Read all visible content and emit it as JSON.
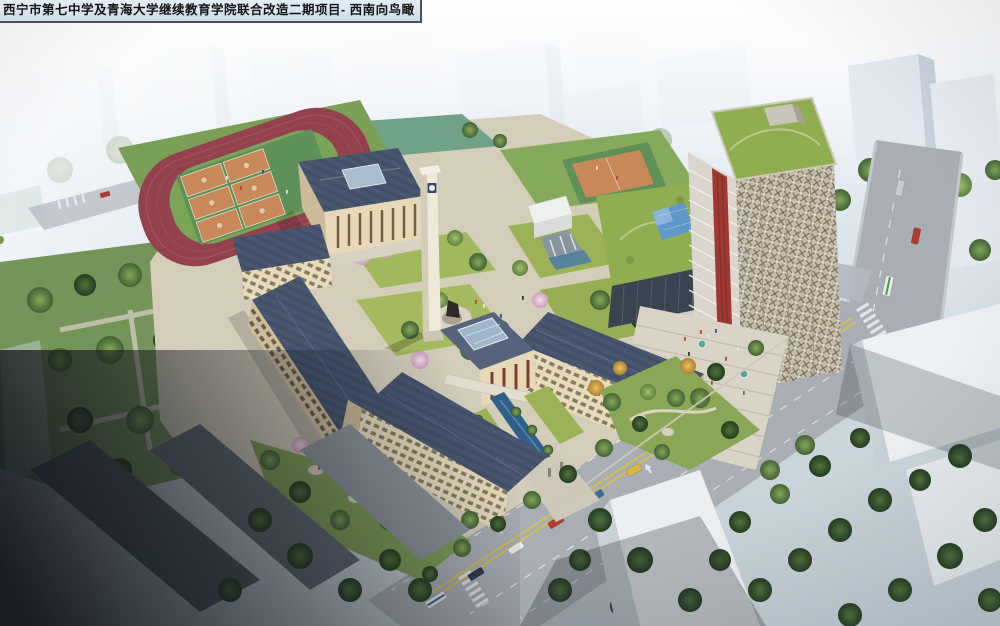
{
  "caption": {
    "title": "西宁市第七中学及青海大学继续教育学院联合改造二期项目- 西南向鸟瞰"
  },
  "scene": {
    "type": "aerial-architectural-rendering",
    "view": "southwest bird's-eye view of a school campus renovation project",
    "landmarks": [
      {
        "id": "running-track",
        "label": "running track with six basketball courts"
      },
      {
        "id": "sports-field-upper",
        "label": "green sports field north of the track"
      },
      {
        "id": "auditorium-building",
        "label": "auditorium with rooftop skylight and colonnade"
      },
      {
        "id": "clock-tower",
        "label": "white campus clock tower"
      },
      {
        "id": "classroom-wings",
        "label": "slate-roofed classroom wings around green courtyards"
      },
      {
        "id": "statue-plaza",
        "label": "circular plaza with statue"
      },
      {
        "id": "entrance-canal",
        "label": "blue water canal at the main entrance with palm trees"
      },
      {
        "id": "education-tower",
        "label": "high-rise tower with roof garden and red accent facade"
      },
      {
        "id": "glass-pyramid",
        "label": "blue glass pyramid skylight on podium roof garden"
      },
      {
        "id": "grand-stairs",
        "label": "grand entrance stairs with pedestrians and teal umbrellas"
      },
      {
        "id": "main-road",
        "label": "city road with traffic, crosswalks and yellow median"
      },
      {
        "id": "context-buildings",
        "label": "faded surrounding city blocks and parks"
      }
    ]
  },
  "colors": {
    "haze_sky": "#e8eef4",
    "campus_paving": "#d3cdba",
    "lawn_green": "#a2b85c",
    "park_green": "#74945a",
    "track_red": "#94414d",
    "infield_green": "#79a556",
    "court_orange": "#c8885a",
    "court_apron_green": "#5e9059",
    "roof_slate": "#46546e",
    "wall_cream": "#e7d9b8",
    "roof_garden_green": "#8fae4f",
    "glass_pyramid_blue": "#5e97c8",
    "tower_red_accent": "#a03a31",
    "tower_facade": "#c7beac",
    "canal_blue": "#2e6089",
    "road_grey": "#a9aeb5",
    "lane_yellow": "#d9c23f",
    "tree_green_dark": "#3c5c30",
    "blossom_pink": "#e3bed2",
    "shadow_dark": "#15191f",
    "caption_bg": "#d7e3ee",
    "caption_text": "#141414"
  }
}
